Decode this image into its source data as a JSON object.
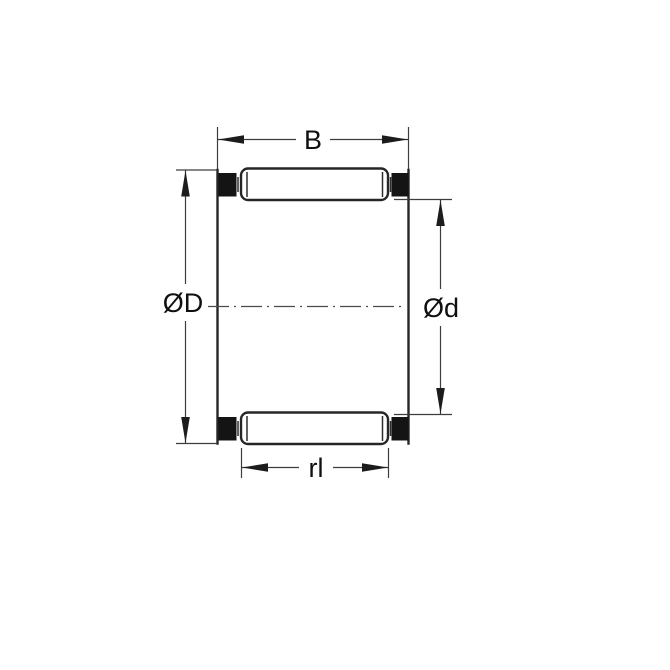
{
  "diagram": {
    "type": "technical-drawing",
    "subject": "needle-roller-and-cage-bearing-cross-section",
    "labels": {
      "width": "B",
      "outer_diameter": "ØD",
      "inner_diameter": "Ød",
      "roller_length": "rl"
    },
    "colors": {
      "background": "#ffffff",
      "object_line": "#262626",
      "dimension_line": "#3d3d3d",
      "cage_section_fill": "#141414",
      "label_text": "#101010"
    }
  }
}
